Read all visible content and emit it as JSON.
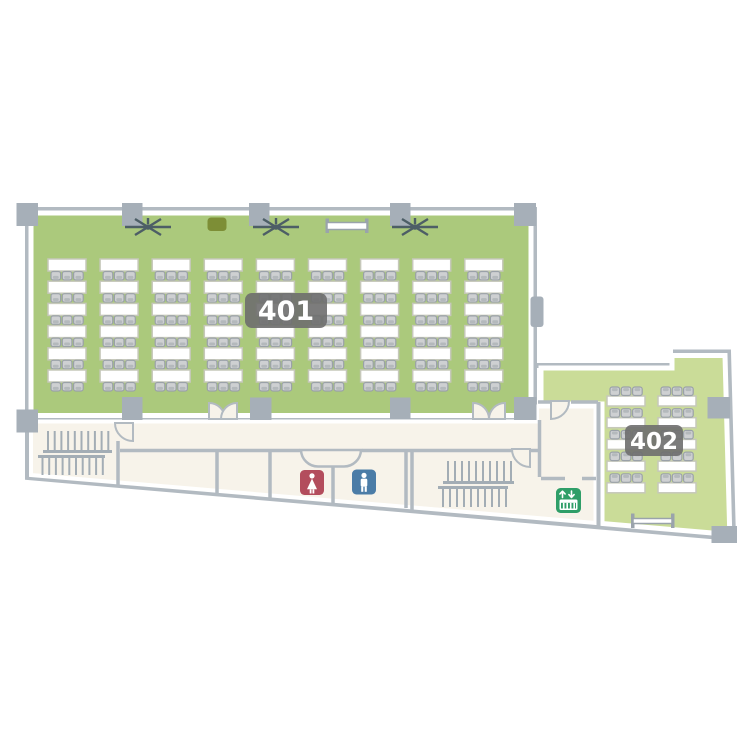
{
  "plan_title": "4F floor plan",
  "rooms": [
    {
      "id": "room-401",
      "label": "401",
      "fill": "#abc97c",
      "type": "classroom",
      "seats": 162,
      "tables": {
        "cols": 9,
        "rows": 6,
        "origin_x": 48,
        "origin_y": 259,
        "pitch_x": 52.1,
        "pitch_y": 22.2,
        "table_w": 38,
        "table_h": 12,
        "chairs_per_table": 3,
        "chair_side": "bottom"
      },
      "equipment": [
        "ceiling-fan",
        "ceiling-fan",
        "ceiling-fan",
        "podium",
        "projection-screen"
      ]
    },
    {
      "id": "room-402",
      "label": "402",
      "fill": "#cadc98",
      "type": "classroom",
      "seats": 30,
      "tables": {
        "cols": 2,
        "rows": 5,
        "origin_x": 607,
        "origin_y": 396,
        "pitch_x": 51,
        "pitch_y": 21.7,
        "table_w": 38,
        "table_h": 10,
        "chairs_per_table": 3,
        "chair_side": "top"
      },
      "equipment": [
        "whiteboard"
      ]
    }
  ],
  "facilities": [
    {
      "id": "restroom-female",
      "icon": "female-restroom-icon",
      "color": "#b34d5d"
    },
    {
      "id": "restroom-male",
      "icon": "male-restroom-icon",
      "color": "#4b7ca7"
    },
    {
      "id": "elevator",
      "icon": "elevator-icon",
      "color": "#2f9e68"
    },
    {
      "id": "stairs-left",
      "icon": "stairs-icon"
    },
    {
      "id": "stairs-right",
      "icon": "stairs-icon"
    }
  ],
  "stairs": [
    {
      "name": "stairs-left",
      "flights": [
        {
          "x0": 48,
          "step": 6.7,
          "count": 10,
          "y1": 431,
          "y2": 451.5,
          "rail": {
            "x1": 43,
            "x2": 112,
            "y": 451.5
          }
        },
        {
          "x0": 42.5,
          "step": 6.7,
          "count": 10,
          "y1": 456.5,
          "y2": 475,
          "rail": {
            "x1": 38,
            "x2": 105,
            "y": 456.5
          }
        }
      ]
    },
    {
      "name": "stairs-right",
      "flights": [
        {
          "x0": 448,
          "step": 7,
          "count": 10,
          "y1": 461,
          "y2": 482.5,
          "rail": {
            "x1": 443,
            "x2": 514,
            "y": 482.5
          }
        },
        {
          "x0": 443,
          "step": 7,
          "count": 10,
          "y1": 487.5,
          "y2": 507,
          "rail": {
            "x1": 438,
            "x2": 508,
            "y": 487.5
          }
        }
      ]
    }
  ],
  "colors": {
    "room_401_fill": "#abc97c",
    "room_402_fill": "#cadc98",
    "corridor_fill": "#f7f3ea",
    "wall": "#b2bac1",
    "column": "#a6afb8",
    "badge": "#6e6e6e",
    "badge_text": "#ffffff",
    "table_fill": "#ffffff",
    "table_stroke": "#c6c8ba",
    "chair_fill": "#ced0d2",
    "chair_stroke": "#9aa1a8",
    "chair_shade": "#b4b9bc",
    "fan": "#4d5e66",
    "podium": "#7d8e36",
    "screen_cap": "#9aa3ab",
    "female_restroom": "#b34d5d",
    "male_restroom": "#4b7ca7",
    "elevator": "#2f9e68",
    "stairs": "#a3adb5"
  }
}
